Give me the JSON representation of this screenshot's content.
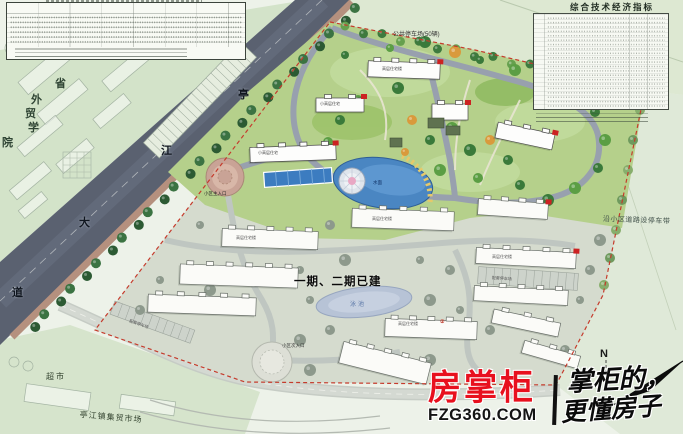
{
  "tables": {
    "indicators_title": "综合技术经济指标"
  },
  "site_labels": {
    "public_parking": "公共停车场(50辆)",
    "roadside_parking": "沿小区道路设停车带",
    "phase_built": "一期、二期已建",
    "swim_pool": "泳池",
    "lake": "水面",
    "main_entrance": "小区主入口",
    "secondary_entrance": "小区次入口",
    "highrise": "高层住宅楼",
    "midrise": "小高层住宅",
    "parking_strip": "配套停车场",
    "building_badge": "②"
  },
  "surroundings": {
    "college_chars": [
      "省",
      "外",
      "贸",
      "学",
      "院"
    ],
    "road_chars": [
      "亭",
      "江",
      "大",
      "道"
    ],
    "supermarket": "超市",
    "market": "亭江镇集贸市场"
  },
  "compass": {
    "north": "N"
  },
  "watermark": {
    "brand": "房掌柜",
    "domain": "FZG360.COM",
    "slogan1": "掌柜的，",
    "slogan2": "更懂房子",
    "brand_color": "#e8101e"
  },
  "colors": {
    "road": "#5a6170",
    "new_phase_lawn": "#b5d08b",
    "built_phase": "#d5dbce",
    "lake_blue": "#4a86c2",
    "boundary_red": "#c53b2c"
  }
}
